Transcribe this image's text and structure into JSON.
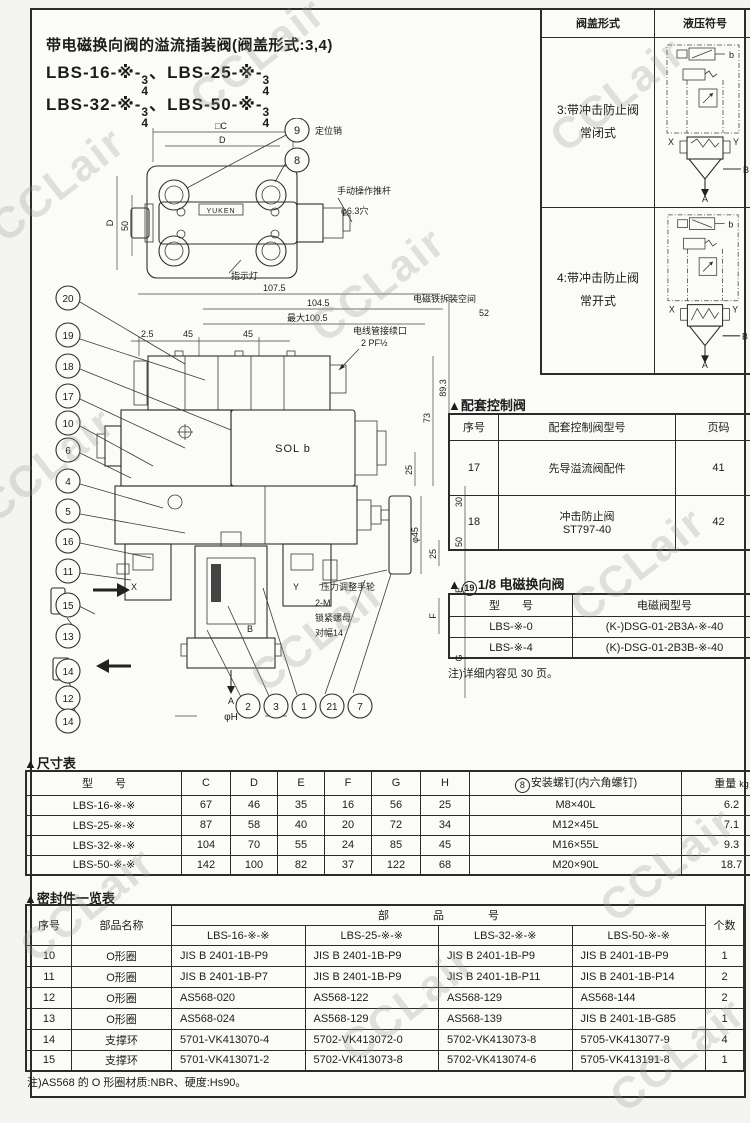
{
  "watermark": "CCLair",
  "title_block": {
    "title": "带电磁换向阀的溢流插装阀(阀盖形式:3,4)",
    "models": [
      {
        "prefix": "LBS-16-※-",
        "num": "3",
        "den": "4",
        "sep": "、"
      },
      {
        "prefix": "LBS-25-※-",
        "num": "3",
        "den": "4"
      },
      {
        "prefix": "LBS-32-※-",
        "num": "3",
        "den": "4",
        "sep": "、"
      },
      {
        "prefix": "LBS-50-※-",
        "num": "3",
        "den": "4"
      }
    ]
  },
  "cover_table": {
    "col1": "阀盖形式",
    "col2": "液压符号",
    "rows": [
      {
        "line1": "3:带冲击防止阀",
        "line2": "常闭式"
      },
      {
        "line1": "4:带冲击防止阀",
        "line2": "常开式"
      }
    ],
    "sym": {
      "b": "b",
      "x": "X",
      "y": "Y",
      "a": "A",
      "bport": "B"
    }
  },
  "matching_valves": {
    "heading": "▲配套控制阀",
    "h_no": "序号",
    "h_model": "配套控制阀型号",
    "h_page": "页码",
    "rows": [
      {
        "no": "17",
        "model": "先导溢流阀配件",
        "model2": "",
        "page": "41"
      },
      {
        "no": "18",
        "model": "冲击防止阀",
        "model2": "ST797-40",
        "page": "42"
      }
    ]
  },
  "solenoid_table": {
    "heading_pre": "▲",
    "heading_num": "19",
    "heading_post": "1/8 电磁换向阀",
    "h_model": "型　　号",
    "h_sol": "电磁阀型号",
    "rows": [
      {
        "model": "LBS-※-0",
        "sol": "(K-)DSG-01-2B3A-※-40"
      },
      {
        "model": "LBS-※-4",
        "sol": "(K)-DSG-01-2B3B-※-40"
      }
    ],
    "note": "注)详细内容见 30 页。"
  },
  "dim_table": {
    "heading": "▲尺寸表",
    "h_model": "型　　号",
    "h_c": "C",
    "h_d": "D",
    "h_e": "E",
    "h_f": "F",
    "h_g": "G",
    "h_h": "H",
    "h_screw_num": "8",
    "h_screw": "安装螺钉(内六角螺钉)",
    "h_weight": "重量",
    "h_weight_unit": "kg",
    "rows": [
      [
        "LBS-16-※-※",
        "67",
        "46",
        "35",
        "16",
        "56",
        "25",
        "M8×40L",
        "6.2"
      ],
      [
        "LBS-25-※-※",
        "87",
        "58",
        "40",
        "20",
        "72",
        "34",
        "M12×45L",
        "7.1"
      ],
      [
        "LBS-32-※-※",
        "104",
        "70",
        "55",
        "24",
        "85",
        "45",
        "M16×55L",
        "9.3"
      ],
      [
        "LBS-50-※-※",
        "142",
        "100",
        "82",
        "37",
        "122",
        "68",
        "M20×90L",
        "18.7"
      ]
    ]
  },
  "seal_table": {
    "heading": "▲密封件一览表",
    "h_no": "序号",
    "h_name": "部品名称",
    "h_part": "部　　　　品　　　　号",
    "h_qty": "个数",
    "models": [
      "LBS-16-※-※",
      "LBS-25-※-※",
      "LBS-32-※-※",
      "LBS-50-※-※"
    ],
    "rows": [
      [
        "10",
        "O形圈",
        "JIS B 2401-1B-P9",
        "JIS B 2401-1B-P9",
        "JIS B 2401-1B-P9",
        "JIS B 2401-1B-P9",
        "1"
      ],
      [
        "11",
        "O形圈",
        "JIS B 2401-1B-P7",
        "JIS B 2401-1B-P9",
        "JIS B 2401-1B-P11",
        "JIS B 2401-1B-P14",
        "2"
      ],
      [
        "12",
        "O形圈",
        "AS568-020",
        "AS568-122",
        "AS568-129",
        "AS568-144",
        "2"
      ],
      [
        "13",
        "O形圈",
        "AS568-024",
        "AS568-129",
        "AS568-139",
        "JIS B 2401-1B-G85",
        "1"
      ],
      [
        "14",
        "支撑环",
        "5701-VK413070-4",
        "5702-VK413072-0",
        "5702-VK413073-8",
        "5705-VK413077-9",
        "4"
      ],
      [
        "15",
        "支撑环",
        "5701-VK413071-2",
        "5702-VK413073-8",
        "5702-VK413074-6",
        "5705-VK413191-8",
        "1"
      ]
    ],
    "note": "注)AS568 的 O 形圈材质:NBR、硬度:Hs90。"
  },
  "drawing": {
    "brand": "YUKEN",
    "sol": "SOL b",
    "callout_9": "9",
    "callout_8": "8",
    "callouts_left": [
      "20",
      "19",
      "18",
      "17",
      "10",
      "6",
      "4",
      "5",
      "16",
      "11",
      "15",
      "13",
      "14",
      "12",
      "14"
    ],
    "callouts_bottom": [
      "2",
      "3",
      "1",
      "21",
      "7"
    ],
    "labels": {
      "pin": "定位销",
      "rod": "手动操作推杆",
      "hole": "φ6.3穴",
      "lamp": "指示灯",
      "space": "电磁铁拆装空间",
      "space_val": "52",
      "conduit": "电线管接续口",
      "conduit_val": "2 PF½",
      "wheel": "压力调整手轮",
      "qty": "2-M",
      "nut": "锁紧螺母",
      "flats": "对幅14"
    },
    "dims": {
      "c": "□C",
      "d": "D",
      "d2": "D",
      "n50": "50",
      "t1": "107.5",
      "t2": "104.5",
      "t3": "最大100.5",
      "s1": "2.5",
      "s2": "45",
      "s3": "45",
      "r1": "89.3",
      "r2": "73",
      "r3": "25",
      "r4": "30",
      "r5": "50",
      "r6": "25",
      "dia": "φ45",
      "e": "E",
      "f": "F",
      "g": "G",
      "phih": "φH",
      "x": "X",
      "y": "Y",
      "a": "A",
      "b": "B"
    }
  }
}
